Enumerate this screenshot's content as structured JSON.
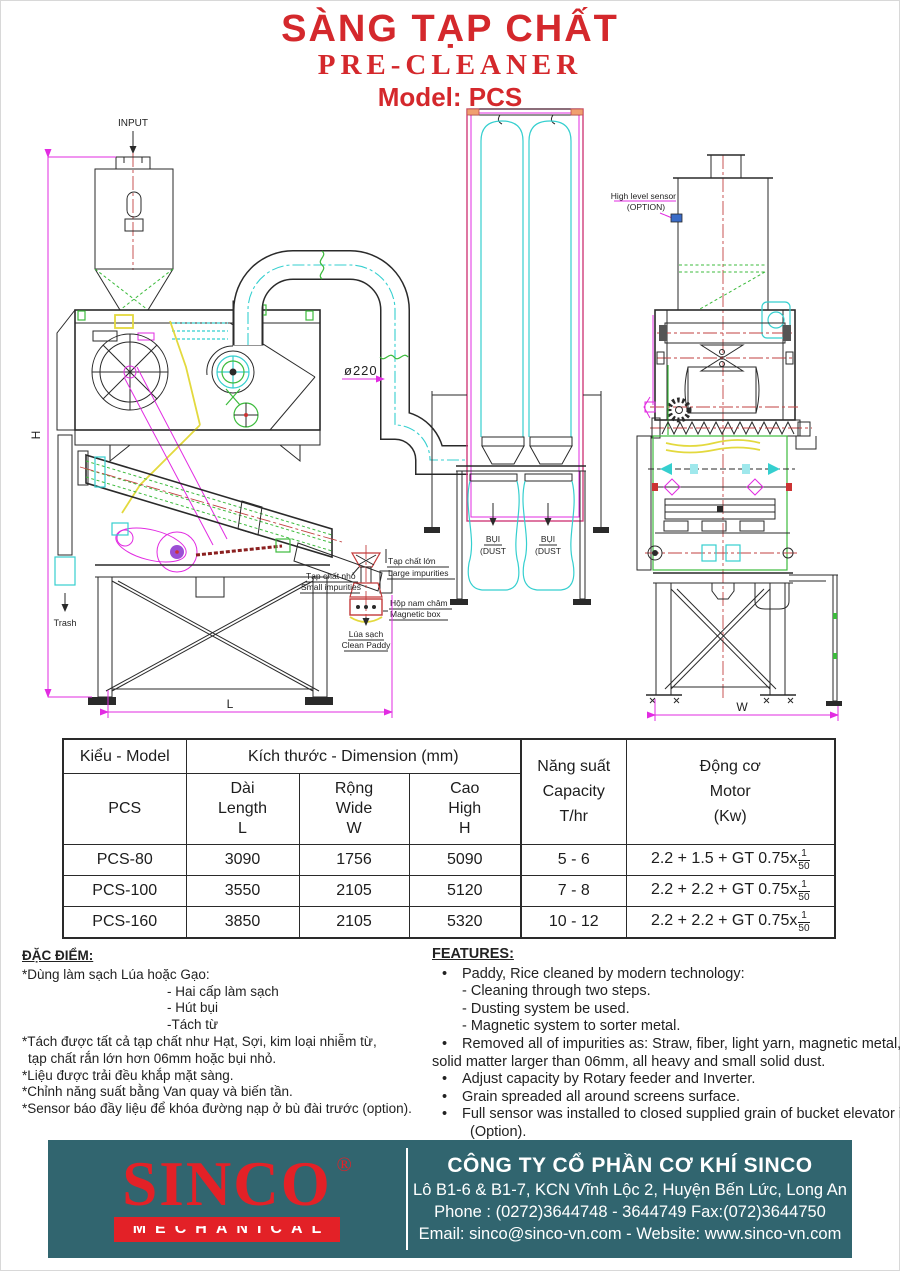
{
  "title": {
    "vi": "SÀNG TẠP CHẤT",
    "en": "PRE-CLEANER",
    "model": "Model: PCS"
  },
  "colors": {
    "title_red": "#d4282c",
    "logo_red": "#e32127",
    "footer_teal": "#31656f",
    "dim_magenta": "#e22be2",
    "cad_cyan": "#35cfcf",
    "cad_green": "#3dbb3d"
  },
  "drawing": {
    "labels": {
      "input": "INPUT",
      "trash": "Trash",
      "dim_h": "H",
      "dim_l": "L",
      "dim_w": "W",
      "duct_dia": "ø220",
      "dust_vi": "BỤI",
      "dust_en": "(DUST",
      "sensor1": "High level sensor",
      "sensor2": "(OPTION)",
      "large_vi": "Tạp chất lớn",
      "large_en": "Large impurities",
      "small_vi": "Tạp chất nhỏ",
      "small_en": "Small impurities",
      "magnet_vi": "Hộp nam châm",
      "magnet_en": "Magnetic box",
      "clean_vi": "Lúa sạch",
      "clean_en": "Clean Paddy"
    }
  },
  "table": {
    "col_model_group": "Kiểu - Model",
    "col_model_sub": "PCS",
    "col_dim_group": "Kích thước - Dimension (mm)",
    "col_length": [
      "Dài",
      "Length",
      "L"
    ],
    "col_wide": [
      "Rộng",
      "Wide",
      "W"
    ],
    "col_high": [
      "Cao",
      "High",
      "H"
    ],
    "col_capacity": [
      "Năng suất",
      "Capacity",
      "T/hr"
    ],
    "col_motor": [
      "Động cơ",
      "Motor",
      "(Kw)"
    ],
    "rows": [
      {
        "model": "PCS-80",
        "length": "3090",
        "wide": "1756",
        "high": "5090",
        "capacity": "5 - 6",
        "motor_prefix": "2.2 + 1.5 + GT 0.75x",
        "frac_num": "1",
        "frac_den": "50"
      },
      {
        "model": "PCS-100",
        "length": "3550",
        "wide": "2105",
        "high": "5120",
        "capacity": "7 - 8",
        "motor_prefix": "2.2 + 2.2 + GT 0.75x",
        "frac_num": "1",
        "frac_den": "50"
      },
      {
        "model": "PCS-160",
        "length": "3850",
        "wide": "2105",
        "high": "5320",
        "capacity": "10 - 12",
        "motor_prefix": "2.2 + 2.2 + GT 0.75x",
        "frac_num": "1",
        "frac_den": "50"
      }
    ]
  },
  "features_vi": {
    "heading": "ĐẶC ĐIỂM:",
    "lines": [
      "*Dùng làm sạch Lúa hoặc Gạo:",
      "- Hai cấp làm sạch",
      "- Hút bụi",
      "-Tách từ",
      "*Tách được tất cả tạp chất như Hạt, Sợi, kim loại nhiễm từ,",
      "tạp chất rắn lớn hơn 06mm hoặc bụi nhỏ.",
      "*Liệu được trải đều khắp mặt sàng.",
      "*Chỉnh năng suất bằng Van quay và biến tần.",
      "*Sensor báo đầy liệu để khóa đường nạp ở bù đài trước (option)."
    ]
  },
  "features_en": {
    "heading": "FEATURES:",
    "bullet": "•",
    "lines": [
      "Paddy, Rice cleaned by modern technology:",
      "- Cleaning through two steps.",
      "- Dusting system be used.",
      "- Magnetic system to sorter metal.",
      "Removed all of impurities as: Straw, fiber, light yarn, magnetic metal,",
      "solid matter larger than 06mm, all heavy and small solid dust.",
      "Adjust capacity by Rotary feeder and Inverter.",
      "Grain spreaded all around screens surface.",
      "Full sensor was installed to closed supplied grain of bucket elevator in front",
      "(Option)."
    ]
  },
  "footer": {
    "logo_text": "SINCO",
    "logo_reg": "®",
    "logo_sub": "MECHANICAL",
    "company": "CÔNG TY CỔ PHẦN CƠ KHÍ SINCO",
    "address": "Lô B1-6 & B1-7, KCN Vĩnh Lộc 2, Huyện Bến Lức, Long An",
    "phone": "Phone : (0272)3644748 - 3644749  Fax:(072)3644750",
    "email": "Email: sinco@sinco-vn.com - Website: www.sinco-vn.com"
  }
}
